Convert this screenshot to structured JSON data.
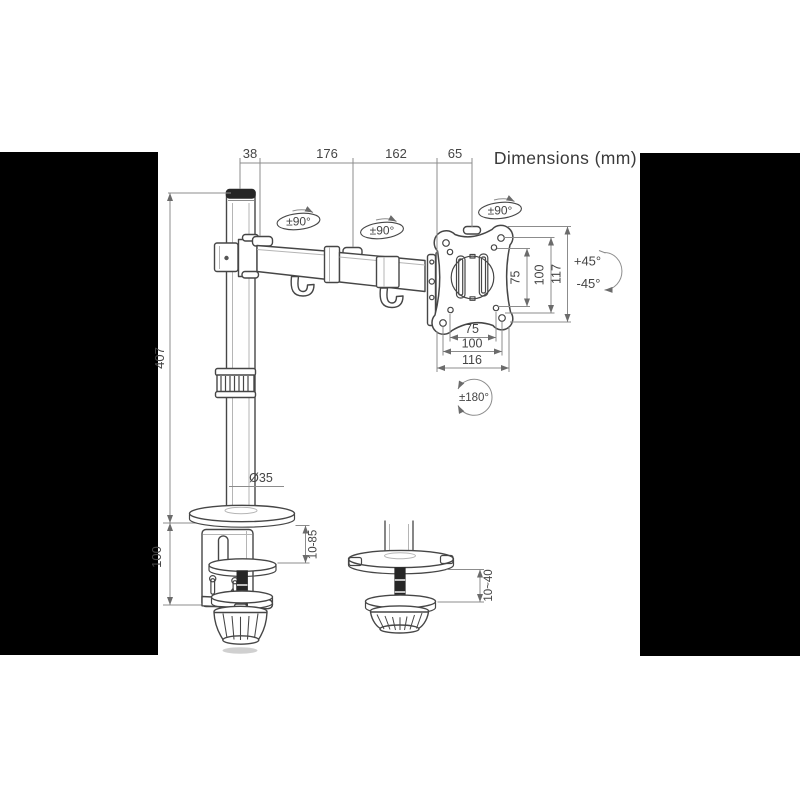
{
  "title": "Dimensions (mm)",
  "dims": {
    "top": {
      "a": "38",
      "b": "176",
      "c": "162",
      "d": "65"
    },
    "pole_height": "407",
    "clamp_body_height": "100",
    "pole_diameter": "Ø35",
    "vesa_right": {
      "a": "75",
      "b": "100",
      "c": "117"
    },
    "vesa_bottom": {
      "a": "75",
      "b": "100",
      "c": "116"
    },
    "clamp_range": "10-85",
    "grommet_range": "10~40"
  },
  "rotation": {
    "swivel": "±90°",
    "tilt_up": "+45°",
    "tilt_down": "-45°",
    "pan": "±180°"
  },
  "colors": {
    "line": "#464646",
    "dimension_line": "#8c8c8c",
    "side_panel": "#000000",
    "background": "#ffffff"
  }
}
